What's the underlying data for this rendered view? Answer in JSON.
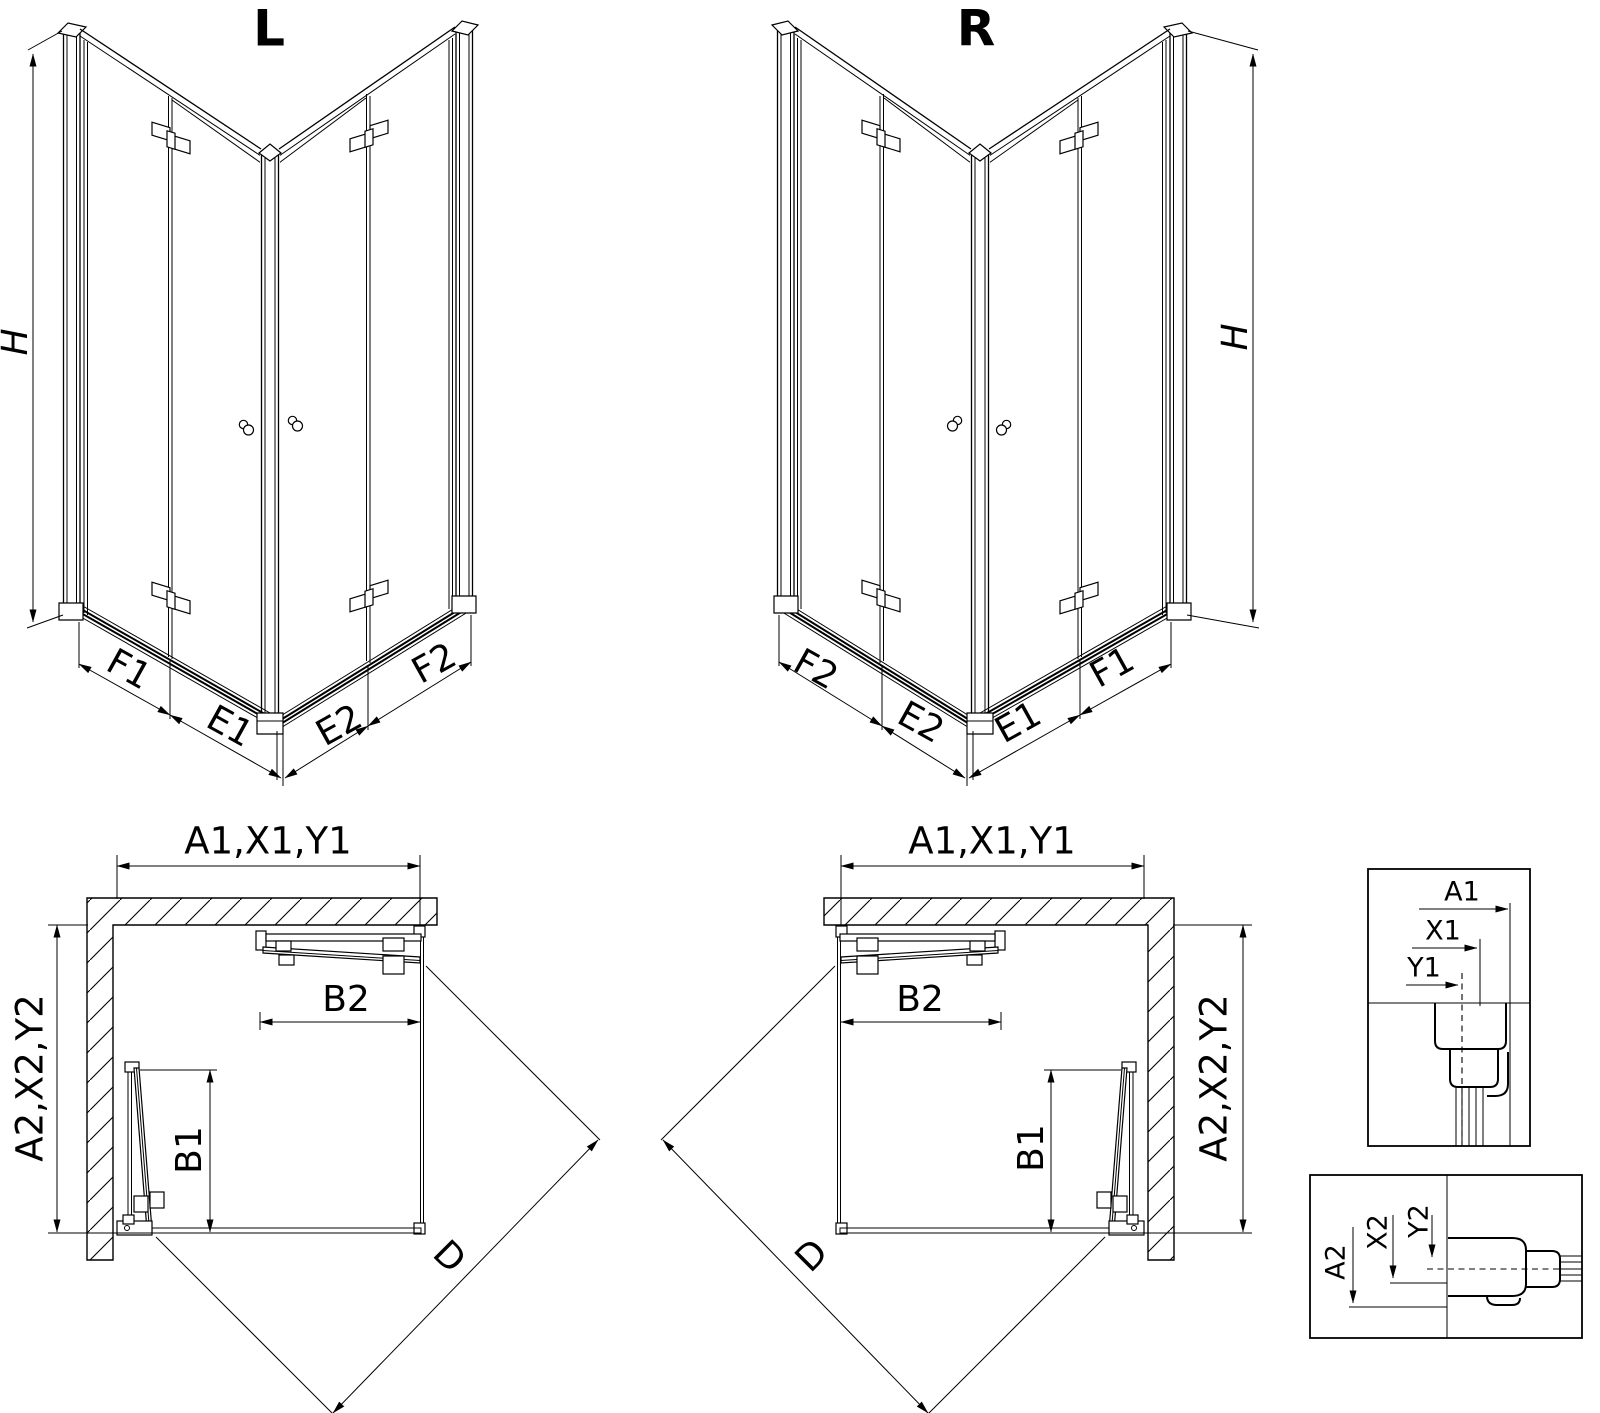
{
  "page": {
    "background": "#ffffff",
    "line_color": "#000000"
  },
  "views": {
    "iso_left": {
      "title": "L",
      "height_label": "H",
      "widths": {
        "f1": "F1",
        "e1": "E1",
        "e2": "E2",
        "f2": "F2"
      }
    },
    "iso_right": {
      "title": "R",
      "height_label": "H",
      "widths": {
        "f2": "F2",
        "e2": "E2",
        "e1": "E1",
        "f1": "F1"
      }
    },
    "plan_left": {
      "top": "A1,X1,Y1",
      "side": "A2,X2,Y2",
      "door_small": "B1",
      "door_large": "B2",
      "diagonal": "D"
    },
    "plan_right": {
      "top": "A1,X1,Y1",
      "side": "A2,X2,Y2",
      "door_small": "B1",
      "door_large": "B2",
      "diagonal": "D"
    },
    "detail_top": {
      "a1": "A1",
      "x1": "X1",
      "y1": "Y1"
    },
    "detail_bottom": {
      "a2": "A2",
      "x2": "X2",
      "y2": "Y2"
    }
  }
}
